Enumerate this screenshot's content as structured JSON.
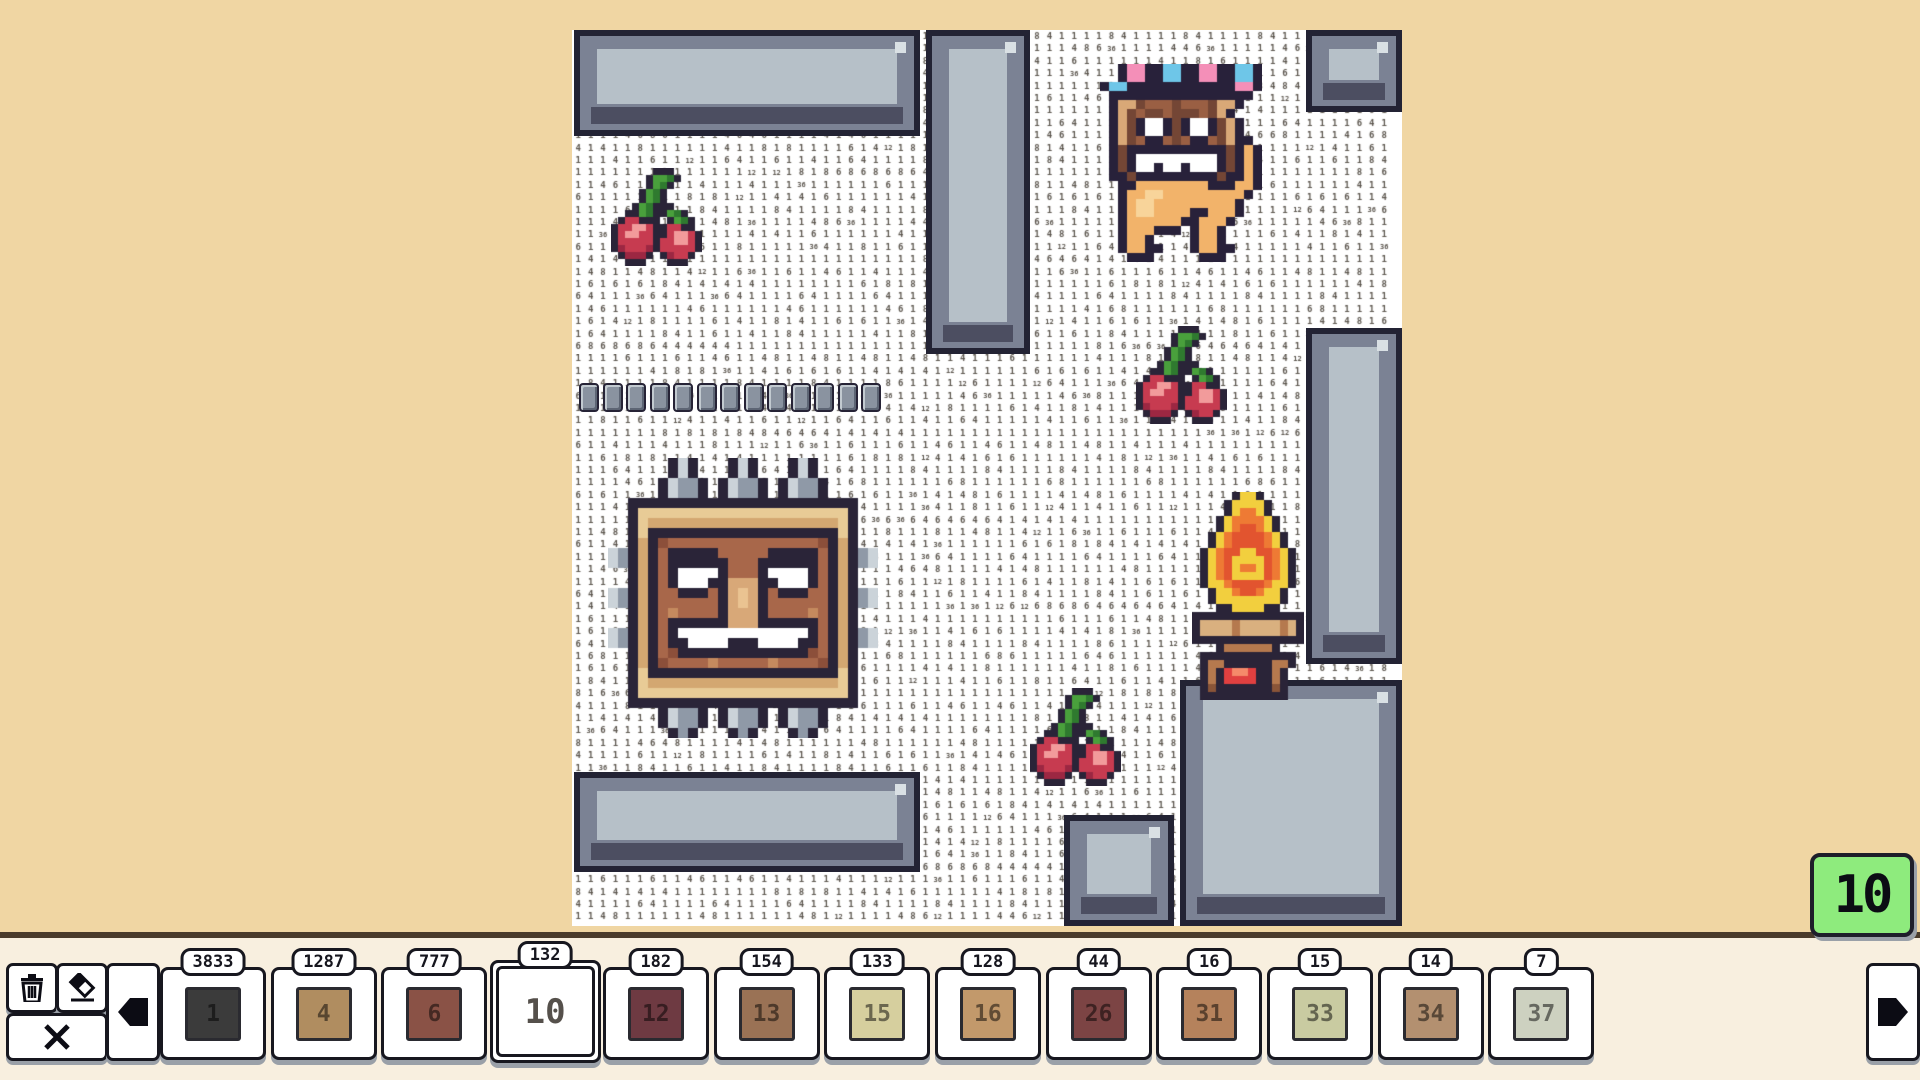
{
  "app": {
    "background": "#f0d6a3",
    "toolbar_bg": "#f8efdf",
    "toolbar_line": "#4a3b2b"
  },
  "progress_badge": {
    "value": "10",
    "bg": "#8eeb7d"
  },
  "toolbar": {
    "trash_icon": "trash-icon",
    "eraser_icon": "eraser-icon",
    "close_icon": "close-icon",
    "prev_icon": "arrow-left-icon",
    "next_icon": "arrow-right-icon",
    "cards": [
      {
        "count": "3833",
        "number": "1",
        "color": "#3b3b3b",
        "selected": false
      },
      {
        "count": "1287",
        "number": "4",
        "color": "#b08d60",
        "selected": false
      },
      {
        "count": "777",
        "number": "6",
        "color": "#8a5246",
        "selected": false
      },
      {
        "count": "132",
        "number": "10",
        "color": "#ffffff",
        "selected": true
      },
      {
        "count": "182",
        "number": "12",
        "color": "#6e3a42",
        "selected": false
      },
      {
        "count": "154",
        "number": "13",
        "color": "#9a7255",
        "selected": false
      },
      {
        "count": "133",
        "number": "15",
        "color": "#d6cf9e",
        "selected": false
      },
      {
        "count": "128",
        "number": "16",
        "color": "#c2996b",
        "selected": false
      },
      {
        "count": "44",
        "number": "26",
        "color": "#7c4444",
        "selected": false
      },
      {
        "count": "16",
        "number": "31",
        "color": "#b5825c",
        "selected": false
      },
      {
        "count": "15",
        "number": "33",
        "color": "#c9cba1",
        "selected": false
      },
      {
        "count": "14",
        "number": "34",
        "color": "#b39070",
        "selected": false
      },
      {
        "count": "7",
        "number": "37",
        "color": "#cdd1c0",
        "selected": false
      }
    ],
    "card_layout": {
      "x0": 160,
      "pitch": 110.7,
      "width": 100,
      "top": 967,
      "height": 87,
      "sel_width": 105,
      "sel_top": 960,
      "sel_height": 97
    }
  },
  "board": {
    "x": 572,
    "y": 30,
    "w": 830,
    "h": 896,
    "bg": "#ffffff",
    "grid": {
      "cell": 12.4,
      "digit_color": "#5c564e",
      "digits": [
        "1",
        "4",
        "6",
        "8",
        "12",
        "36"
      ]
    },
    "block_colors": {
      "outline": "#232334",
      "mid": "#7b8294",
      "light": "#b6c0c8",
      "dark": "#4c4e61",
      "glint": "#d9e0e4"
    },
    "blocks": [
      {
        "x": 574,
        "y": 30,
        "w": 346,
        "h": 106
      },
      {
        "x": 926,
        "y": 30,
        "w": 104,
        "h": 324
      },
      {
        "x": 1306,
        "y": 30,
        "w": 96,
        "h": 82
      },
      {
        "x": 1306,
        "y": 328,
        "w": 96,
        "h": 336
      },
      {
        "x": 1180,
        "y": 680,
        "w": 222,
        "h": 246
      },
      {
        "x": 574,
        "y": 772,
        "w": 346,
        "h": 100
      },
      {
        "x": 1064,
        "y": 815,
        "w": 110,
        "h": 111
      }
    ],
    "chain": {
      "x": 579,
      "y": 383,
      "beads": 13,
      "bead_w": 16,
      "bead_h": 25,
      "gap": 3.5
    }
  },
  "sprites": {
    "cherry": {
      "scale": 7,
      "palette": {
        "K": "#2a2438",
        "G": "#49a03c",
        "D": "#2f7a2f",
        "R": "#c73b50",
        "M": "#9c2742",
        "P": "#f29b9b"
      },
      "rows": [
        "......KKK....",
        ".....KGGDK...",
        ".....KGDK....",
        "....KGDK.....",
        "....KGDK.....",
        "...KGDKKK....",
        "..KKGDKKGDK..",
        ".KRRKKK.KGDK.",
        "KRRPPRKKRRKK.",
        "KRPPRRKKRPPRK",
        "KRRRRRKRRPPRK",
        "KMRRRMKRRRRRK",
        ".KMMMK.KMRRK.",
        "..KKK...KKK.."
      ],
      "instances": [
        {
          "x": 611,
          "y": 168
        },
        {
          "x": 1136,
          "y": 326
        },
        {
          "x": 1030,
          "y": 688
        }
      ]
    },
    "totem": {
      "scale": 10,
      "palette": {
        "K": "#2a2438",
        "S": "#cbd3d9",
        "s": "#8f99a7",
        "W": "#e8cb96",
        "w": "#d3a771",
        "B": "#a8674a",
        "b": "#8c4f3a",
        "L": "#c58a5e",
        "N": "#d8a878",
        "n": "#eac391",
        "T": "#ffffff"
      },
      "rows": [
        "......KSK...KSK...KSK......",
        "......KSK...KSK...KSK......",
        ".....KSssK.KSssK.KSssK.....",
        ".....KSssK.KSssK.KSssK.....",
        "..KKKKKKKKKKKKKKKKKKKKKKK..",
        "..KWWWWWWWWWWWWWWWWWWWWWK..",
        "..KWwwwwwwwwwwwwwwwwwwwWK..",
        "..KWKKKKKKKKKKKKKKKKKKKWK..",
        "..KwKbBBBBBBBBBBBBBBBbKwK..",
        "SsKwKBKKKKKBBBBBKKKKKBKwKsS",
        "SsKwKBKKKKKKBBBKKKKKKBKwKsS",
        "..KwKBKTTTTKBBBKTTTTKBKwK..",
        "..KwKBKTTTKKNNNKKTTTKBKwK..",
        "SsKwKBBKKKBKNnNKBKKKBBKwKsS",
        "SsKwKBBBBBBKNnNKBBBBBBKwKsS",
        "..KwKBLBBBBKNNNKBBBBLBKwK..",
        "..KwKBKKKKKKNNNKKKKKKBKwK..",
        "SsKwKBKTTTTTTTTTTTTTKBKwKsS",
        "SsKwKBKKTTTTKKKTTTTKKBKwKsS",
        "..KwKBbKKKKKKKKKKKKKbBKwK..",
        "..KwKbBBBBLBBBBBLBBBBbKwK..",
        "..KWKKKKKKKKKKKKKKKKKKKWK..",
        "..KWwwwwwwwwwwwwwwwwwwwWK..",
        "..KWWWWWWWWWWWWWWWWWWWWWK..",
        "..KKKKKKKKKKKKKKKKKKKKKKK..",
        ".....KSssK.KSssK.KSssK.....",
        ".....KSssK.KSssK.KSssK.....",
        "......KsK...KsK...KsK......"
      ],
      "instances": [
        {
          "x": 608,
          "y": 458
        }
      ]
    },
    "creature": {
      "scale": 9,
      "palette": {
        "K": "#28213a",
        "p": "#f48fb8",
        "u": "#6ec6e8",
        "B": "#9a5f43",
        "b": "#744635",
        "L": "#d9a877",
        "O": "#f2b36a",
        "o": "#f8d49a",
        "T": "#ffffff"
      },
      "rows": [
        "..KppKKuuKKppKKuuK",
        "..KppKKuuKKppKKuuK",
        "KuuKKKKKKKKKKKKppK",
        ".KKKKKKKKKKKKKKKK.",
        ".KLLbBBBbBBBbLLK..",
        ".KLbBbbBbbbBbLK...",
        ".KLbKTTKbKTTKbLK..",
        ".KLbKTTKbKTTKbLK..",
        ".KLbBKKBbBKKBbLKK.",
        ".KbKKKKKKKKKKKbKOK",
        ".KbKTTTTTTTTTKbKOK",
        ".KbKTTKTTKTTTKbKOK",
        ".KKbKKKKKKKKKbKKOK",
        "..KKOOOOOOOOKKKOOK",
        "..KOOooOOOOOOOOOK.",
        "..KOooOOOOOOOOOK..",
        "..KOooOOOOKKOOOK..",
        "..KOOOOOOKKOOOK...",
        "..KOOOKKK.KOOK....",
        "..KOOK....KOOK....",
        "..KOOKK...KOOKK...",
        "...KKK.....KKK...."
      ],
      "instances": [
        {
          "x": 1100,
          "y": 64
        }
      ]
    },
    "firepit": {
      "scale": 8,
      "palette": {
        "K": "#2a2438",
        "Y": "#f2cf3e",
        "O": "#ee7a34",
        "R": "#e2542f",
        "P": "#d9b07f",
        "Q": "#b5794e",
        "q": "#8a5538",
        "G": "#e04040",
        "g": "#f58a6a"
      },
      "rows": [
        ".....KYYK.....",
        "....KYYYYK....",
        "....KYOOYK....",
        "...KYOOOOYK...",
        "...KYORROYK...",
        "..KYORRRROYK..",
        "..KYORRRROYK..",
        ".KYORRYYRROYK.",
        ".KYORYYYYROYK.",
        ".KYORYOOYROYK.",
        ".KYORYYYYROYK.",
        ".KYYORRRROYYK.",
        "..KYYORROYYK..",
        "..KYYYYYYYYK..",
        "...KKYYYYKK...",
        "KKKKKKKKKKKKKK",
        "KPPPPQPPPPPQPK",
        "KPPPPQPPPPPQPK",
        "KKKKKKKKKKKKKK",
        "...KQQQQQQK...",
        ".KKKKKKKKKKKK.",
        ".KQQKKKKKKQQK.",
        ".KQKGggGKKQK..",
        ".KQKGGGGKKQK..",
        ".KqKKKKKKKqK..",
        ".KKKKKKKKKKK.."
      ],
      "instances": [
        {
          "x": 1192,
          "y": 492
        }
      ]
    }
  }
}
